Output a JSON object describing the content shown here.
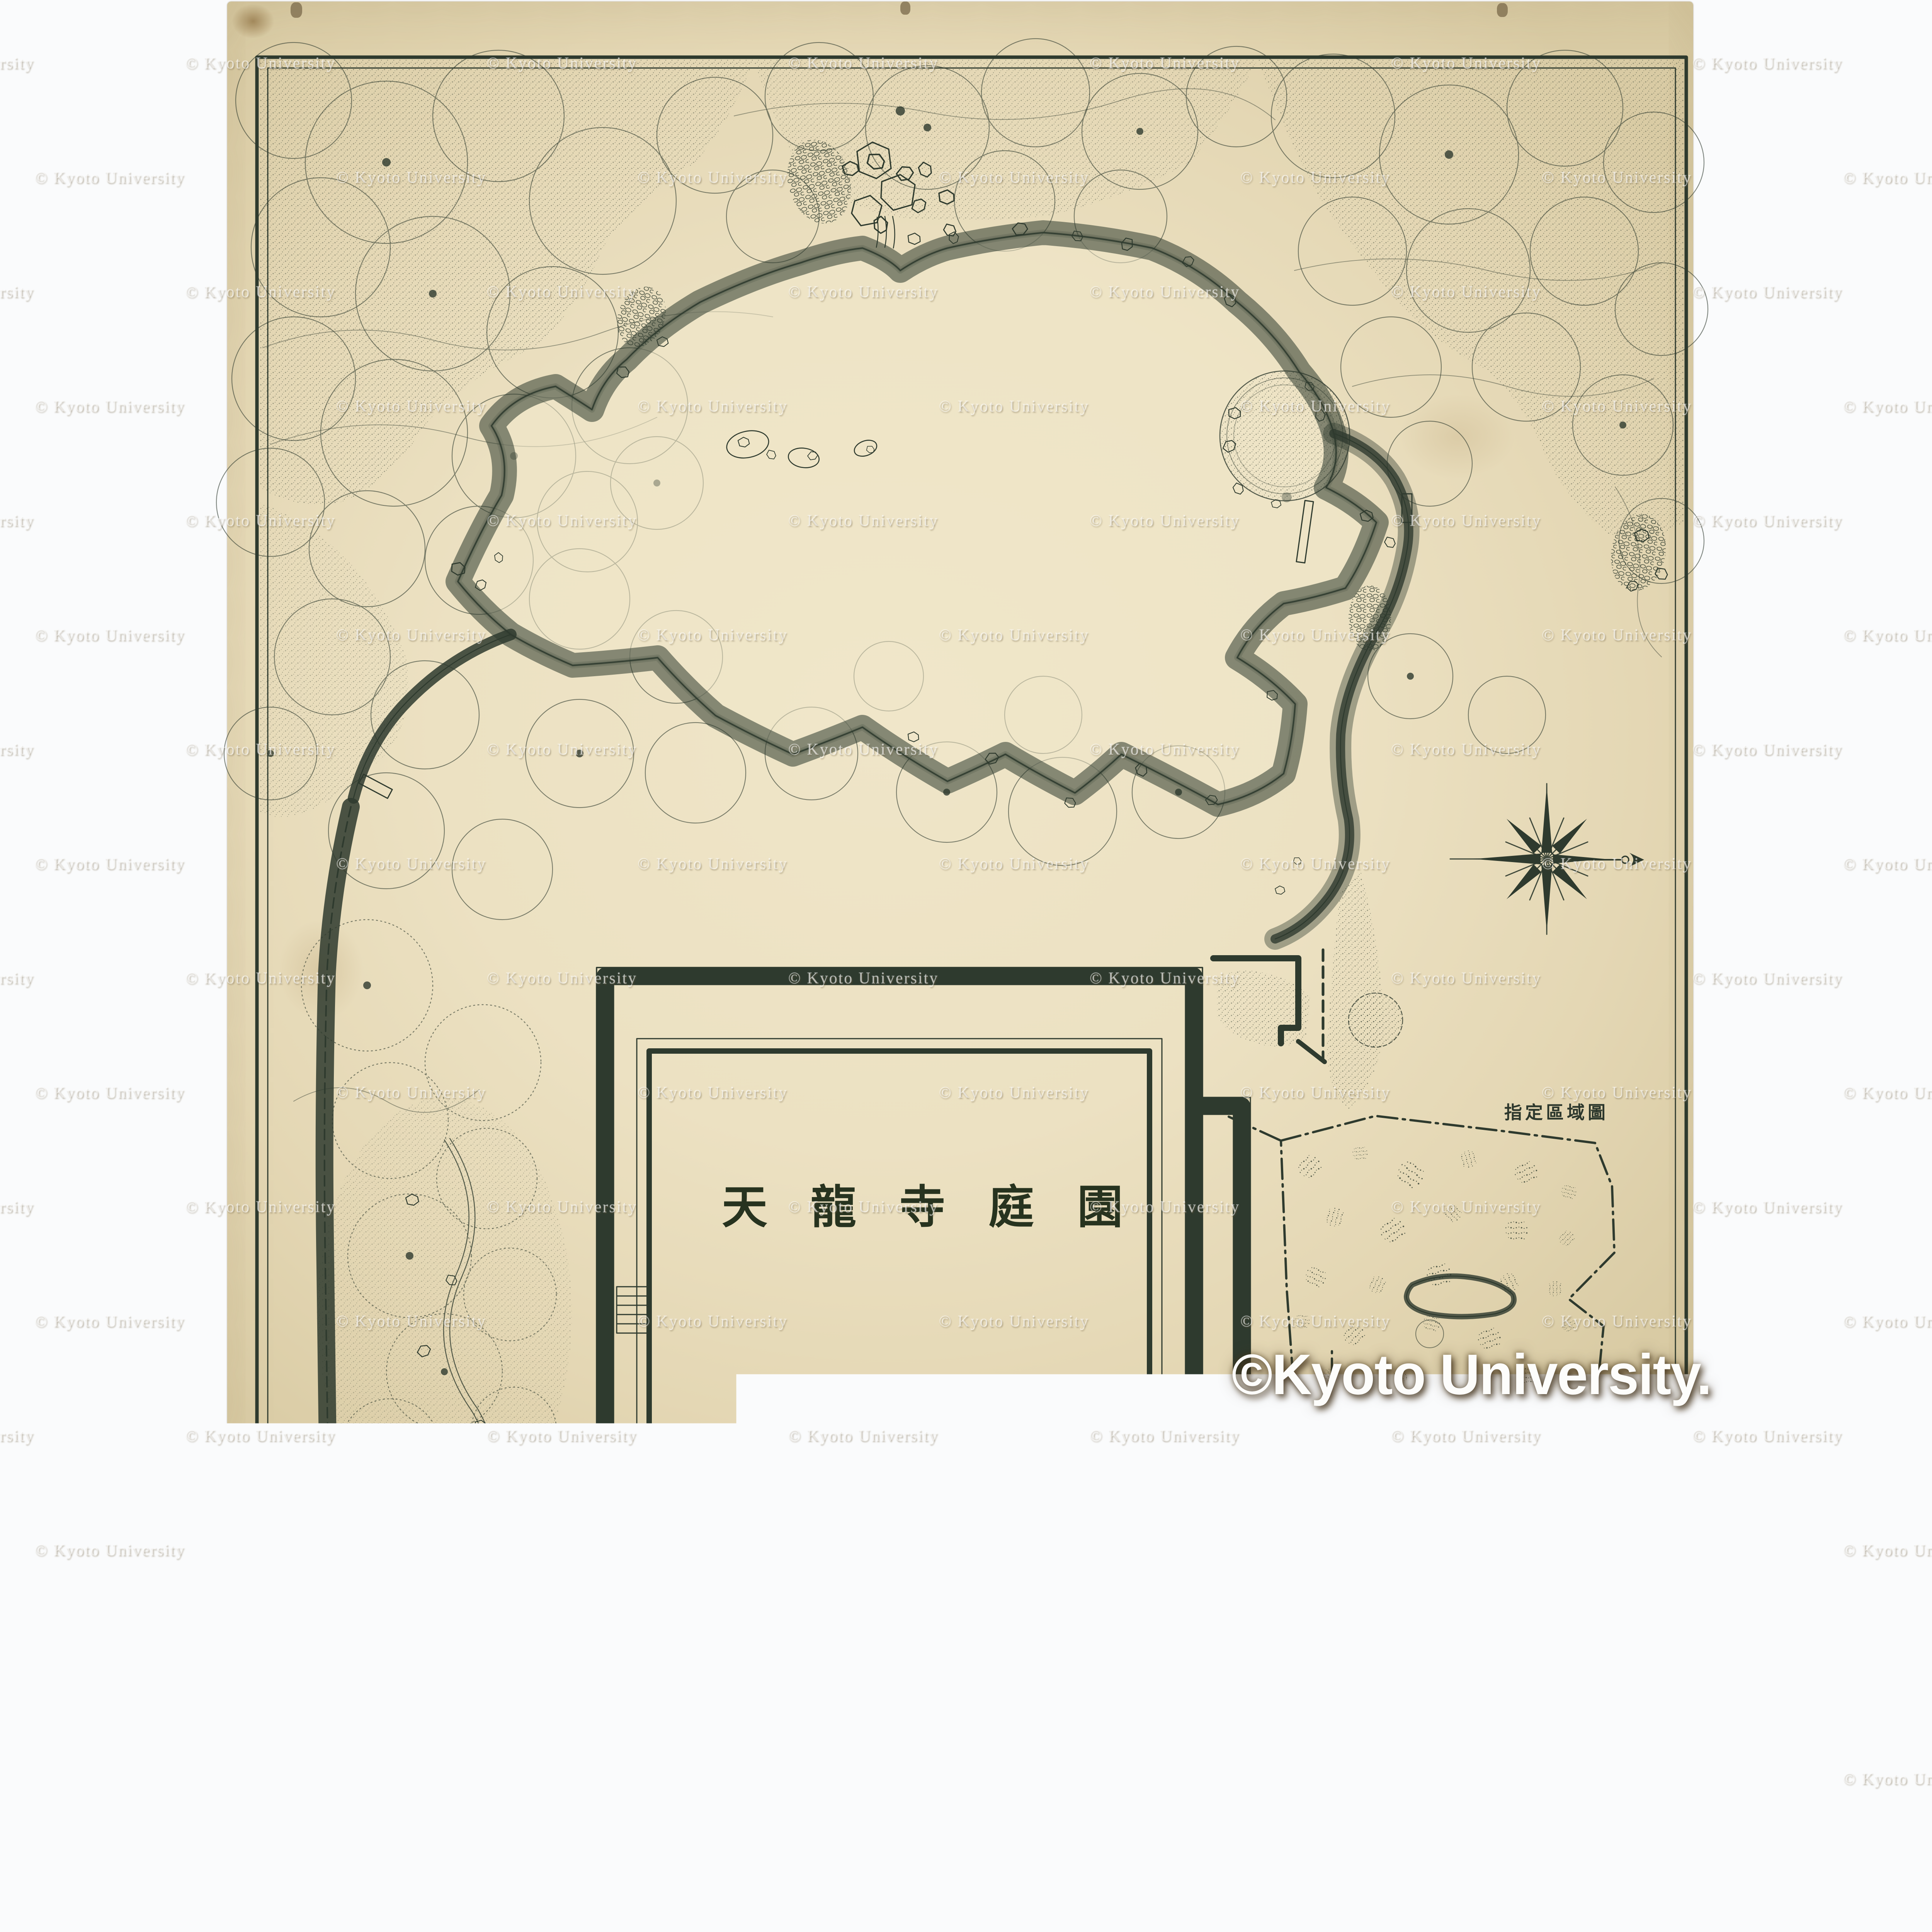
{
  "sheet": {
    "title": "天龍寺庭園",
    "inset": {
      "title": "指定區域圖",
      "legend_boundary": "指定區域",
      "legend_scale": "縮尺六百分之一",
      "scalebar": {
        "top": [
          "20",
          "10",
          "0",
          "20米"
        ],
        "bottom": [
          "10",
          "5",
          "0",
          "10間"
        ]
      }
    },
    "main_scale": {
      "label": "縮尺百分之一",
      "scalebar": {
        "top": [
          "5",
          "4",
          "3",
          "2",
          "1",
          "0",
          "5",
          "10米"
        ],
        "bottom": [
          "尺6",
          "0",
          "1",
          "2",
          "3",
          "4",
          "5間"
        ]
      }
    },
    "date_line": "昭和十七年二月",
    "credit_line": "京都帝國大學農學部造園學研究室"
  },
  "watermarks": {
    "small": "© Kyoto University",
    "large": "©Kyoto University."
  },
  "colors": {
    "ink": "#2e3a2e",
    "paper": "#ece1c2",
    "paper_edge": "#d9cba4",
    "background": "#fafbfc",
    "watermark": "#ffffff"
  }
}
